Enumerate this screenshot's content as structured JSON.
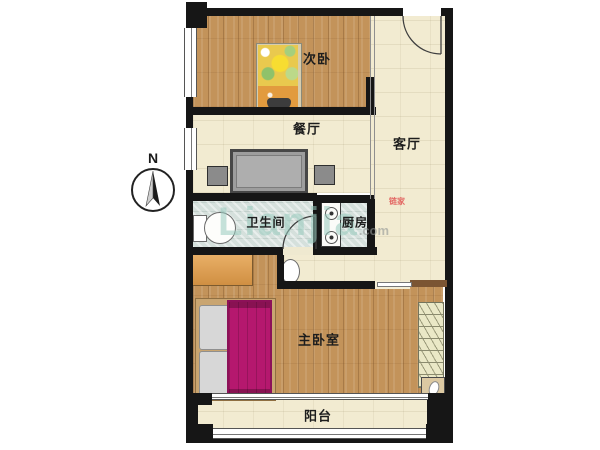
{
  "compass": {
    "letter": "N"
  },
  "rooms": {
    "bedroom2": "次卧",
    "dining": "餐厅",
    "living": "客厅",
    "bathroom": "卫生间",
    "kitchen": "厨房",
    "master": "主卧室",
    "balcony": "阳台"
  },
  "watermark": {
    "brand": "Lianjia",
    "suffix": ".com",
    "badge": "链家"
  },
  "colors": {
    "wall": "#161616",
    "wood_floor": "#c3935a",
    "cream_floor": "#f2ebd1",
    "tile_floor": "#d5e0dc",
    "master_bed_blanket": "#b5186e",
    "cabinet_orange": "#e2a254",
    "watermark_teal": "#97cbbd"
  }
}
